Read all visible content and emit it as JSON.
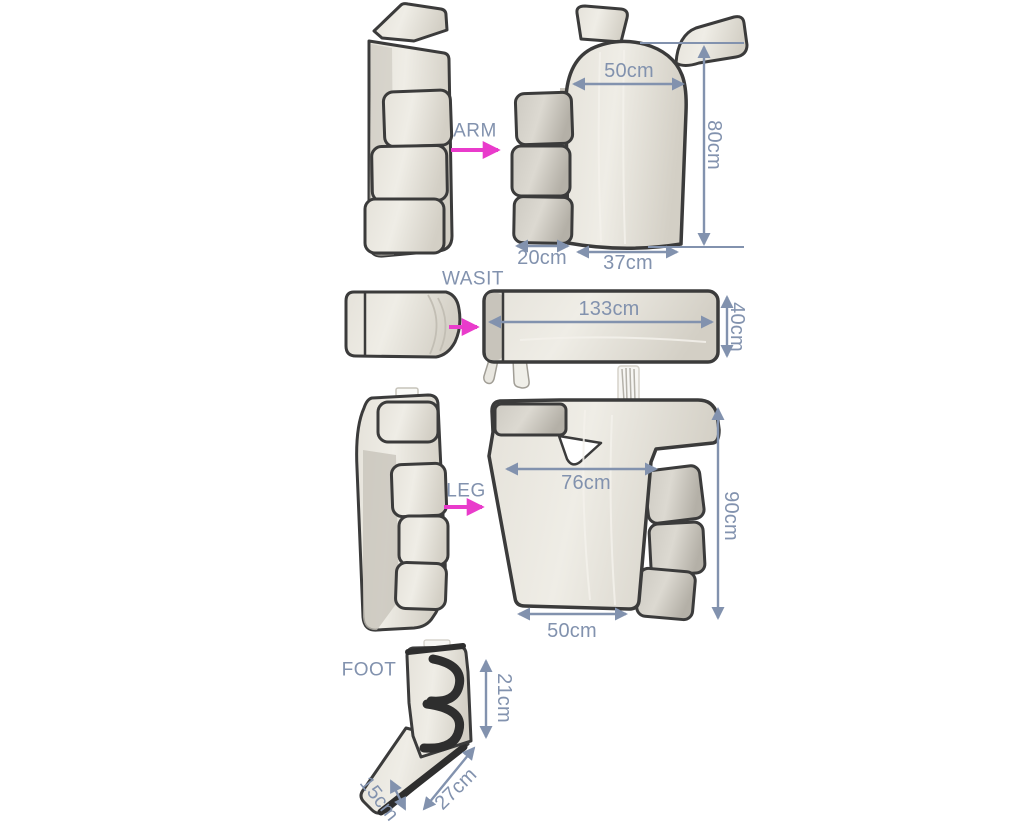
{
  "colors": {
    "dimension_annotation": "#8292ae",
    "transform_arrow": "#e93bcb",
    "fabric_light": "#e7e4dc",
    "fabric_dark": "#b6b2a9",
    "trim": "#3b3b3b",
    "background": "#ffffff"
  },
  "sections": {
    "arm": {
      "label": "ARM",
      "dims": {
        "top_width": "50cm",
        "height": "80cm",
        "flap_width": "20cm",
        "bottom_width": "37cm"
      }
    },
    "waist": {
      "label": "WASIT",
      "dims": {
        "length": "133cm",
        "height": "40cm"
      }
    },
    "leg": {
      "label": "LEG",
      "dims": {
        "top_width": "76cm",
        "height": "90cm",
        "bottom_width": "50cm"
      }
    },
    "foot": {
      "label": "FOOT",
      "dims": {
        "height": "21cm",
        "length": "27cm",
        "width": "15cm"
      }
    }
  }
}
